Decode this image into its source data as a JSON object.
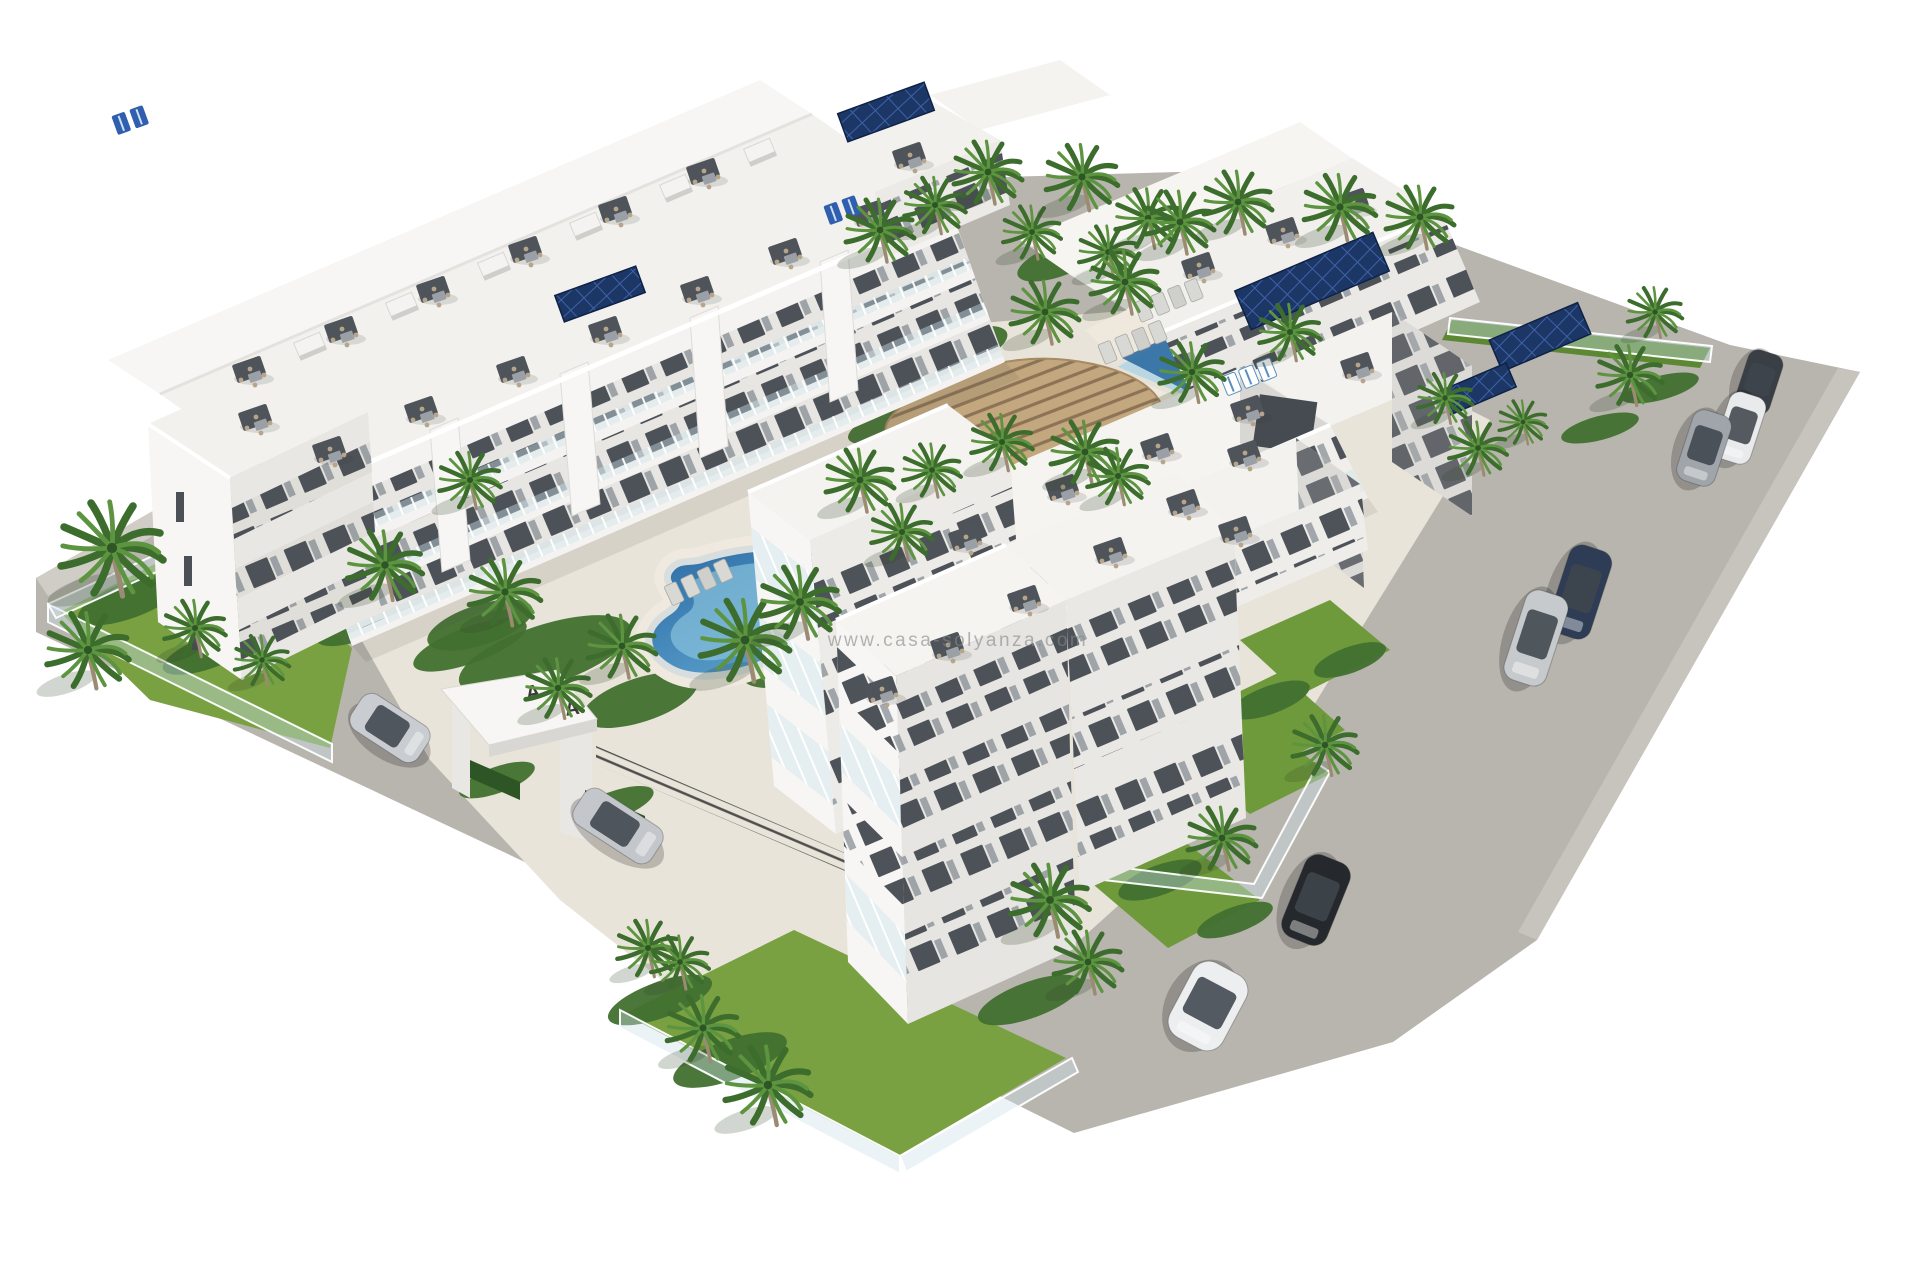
{
  "image": {
    "kind": "3d-architectural-render",
    "description": "Aerial 3D render of a white modern apartment complex with central kidney-shaped pool, rectangular lap pool, wooden pergola, palm gardens, perimeter roads and parked cars",
    "width": 1920,
    "height": 1280
  },
  "watermark": {
    "text": "www.casa-solyanza.com",
    "color": "#868686",
    "opacity": 0.6,
    "x": 958,
    "y": 646,
    "size": 19
  },
  "palette": {
    "bg": "#ffffff",
    "road": "#b8b4ae",
    "sidewalk": "#d0ccc6",
    "courtyard": "#e9e4da",
    "deckpad": "#efe9df",
    "bldg_top": "#f5f4f1",
    "bldg_lit": "#f7f6f4",
    "bldg_mid": "#eceae6",
    "bldg_shade": "#d9d7d3",
    "bldg_deep": "#c2c1bd",
    "window_dark": "#40464d",
    "glass": "#bccfd8",
    "lawn": "#79a141",
    "lawn_dark": "#5d8833",
    "foliage": "#41702f",
    "foliage_dark": "#2e5525",
    "palm1": "#3c6d2d",
    "palm2": "#5d9440",
    "trunk": "#9b8b72",
    "pool_deep": "#2f6da2",
    "pool_mid": "#5d9fc6",
    "pool_light": "#8ec6de",
    "pool_pale": "#b9d6e3",
    "coping": "#d8dedd",
    "pergola_wood": "#c3a87f",
    "pergola_line": "#8d7356",
    "deck_wood": "#d2b58d",
    "solar": "#1c3666",
    "solar_line": "#3f62a8",
    "fence_dark": "#343434",
    "rail_glass": "rgba(206,226,234,0.45)",
    "shadow": "rgba(60,70,55,0.18)"
  },
  "scene": {
    "pools": {
      "kidney_pool": {
        "cx": 770,
        "cy": 614,
        "note": "organic kidney shape, center-left courtyard"
      },
      "lap_pool": {
        "corners": [
          [
            1213,
            312
          ],
          [
            1293,
            353
          ],
          [
            1190,
            400
          ],
          [
            1112,
            367
          ]
        ],
        "note": "rotated rectangular pool, upper right courtyard"
      }
    },
    "entrance": {
      "letters": [
        "A",
        "A"
      ],
      "letter_color": "#3a3a3a"
    },
    "palms": [
      {
        "x": 880,
        "y": 230,
        "s": 1.0,
        "layer": "back"
      },
      {
        "x": 935,
        "y": 205,
        "s": 0.9,
        "layer": "back"
      },
      {
        "x": 988,
        "y": 172,
        "s": 1.0,
        "layer": "back"
      },
      {
        "x": 1032,
        "y": 232,
        "s": 0.85,
        "layer": "back"
      },
      {
        "x": 1082,
        "y": 177,
        "s": 1.05,
        "layer": "back"
      },
      {
        "x": 1108,
        "y": 252,
        "s": 0.85,
        "layer": "back"
      },
      {
        "x": 1148,
        "y": 218,
        "s": 0.95,
        "layer": "back"
      },
      {
        "x": 1180,
        "y": 222,
        "s": 1.0,
        "layer": "back"
      },
      {
        "x": 1238,
        "y": 202,
        "s": 1.0,
        "layer": "back"
      },
      {
        "x": 1340,
        "y": 207,
        "s": 1.05,
        "layer": "back"
      },
      {
        "x": 1420,
        "y": 217,
        "s": 1.0,
        "layer": "back"
      },
      {
        "x": 1445,
        "y": 398,
        "s": 0.8,
        "layer": "back"
      },
      {
        "x": 1523,
        "y": 422,
        "s": 0.7,
        "layer": "back"
      },
      {
        "x": 1655,
        "y": 312,
        "s": 0.8,
        "layer": "back"
      },
      {
        "x": 112,
        "y": 548,
        "s": 1.5,
        "layer": "front"
      },
      {
        "x": 88,
        "y": 650,
        "s": 1.2,
        "layer": "front"
      },
      {
        "x": 195,
        "y": 628,
        "s": 0.9,
        "layer": "front"
      },
      {
        "x": 262,
        "y": 660,
        "s": 0.8,
        "layer": "front"
      },
      {
        "x": 385,
        "y": 565,
        "s": 1.1,
        "layer": "front"
      },
      {
        "x": 470,
        "y": 480,
        "s": 0.9,
        "layer": "front"
      },
      {
        "x": 505,
        "y": 592,
        "s": 1.05,
        "layer": "front"
      },
      {
        "x": 558,
        "y": 688,
        "s": 0.95,
        "layer": "front"
      },
      {
        "x": 622,
        "y": 646,
        "s": 1.0,
        "layer": "front"
      },
      {
        "x": 745,
        "y": 640,
        "s": 1.3,
        "layer": "front"
      },
      {
        "x": 800,
        "y": 602,
        "s": 1.15,
        "layer": "front"
      },
      {
        "x": 860,
        "y": 480,
        "s": 1.0,
        "layer": "front"
      },
      {
        "x": 902,
        "y": 532,
        "s": 0.9,
        "layer": "front"
      },
      {
        "x": 932,
        "y": 470,
        "s": 0.85,
        "layer": "front"
      },
      {
        "x": 1002,
        "y": 442,
        "s": 0.9,
        "layer": "front"
      },
      {
        "x": 1085,
        "y": 452,
        "s": 1.0,
        "layer": "front"
      },
      {
        "x": 1118,
        "y": 476,
        "s": 0.9,
        "layer": "front"
      },
      {
        "x": 1045,
        "y": 312,
        "s": 1.0,
        "layer": "front"
      },
      {
        "x": 1125,
        "y": 282,
        "s": 1.0,
        "layer": "front"
      },
      {
        "x": 1192,
        "y": 372,
        "s": 0.95,
        "layer": "front"
      },
      {
        "x": 1290,
        "y": 332,
        "s": 0.9,
        "layer": "front"
      },
      {
        "x": 1478,
        "y": 448,
        "s": 0.85,
        "layer": "front"
      },
      {
        "x": 1630,
        "y": 375,
        "s": 0.95,
        "layer": "front"
      },
      {
        "x": 648,
        "y": 948,
        "s": 0.9,
        "layer": "front"
      },
      {
        "x": 680,
        "y": 962,
        "s": 0.85,
        "layer": "front"
      },
      {
        "x": 703,
        "y": 1028,
        "s": 1.05,
        "layer": "front"
      },
      {
        "x": 768,
        "y": 1085,
        "s": 1.25,
        "layer": "front"
      },
      {
        "x": 1050,
        "y": 900,
        "s": 1.15,
        "layer": "front"
      },
      {
        "x": 1088,
        "y": 962,
        "s": 1.0,
        "layer": "front"
      },
      {
        "x": 1222,
        "y": 838,
        "s": 1.0,
        "layer": "front"
      },
      {
        "x": 1325,
        "y": 745,
        "s": 0.95,
        "layer": "front"
      }
    ],
    "bushes": [
      {
        "x": 545,
        "y": 655,
        "rx": 90,
        "ry": 30,
        "rot": -18
      },
      {
        "x": 640,
        "y": 700,
        "rx": 60,
        "ry": 22,
        "rot": -18
      },
      {
        "x": 480,
        "y": 625,
        "rx": 55,
        "ry": 20,
        "rot": -18
      },
      {
        "x": 800,
        "y": 660,
        "rx": 60,
        "ry": 22,
        "rot": -18
      },
      {
        "x": 900,
        "y": 300,
        "rx": 70,
        "ry": 22,
        "rot": -20
      },
      {
        "x": 960,
        "y": 350,
        "rx": 50,
        "ry": 18,
        "rot": -20
      },
      {
        "x": 1060,
        "y": 260,
        "rx": 45,
        "ry": 16,
        "rot": -20
      },
      {
        "x": 1210,
        "y": 290,
        "rx": 70,
        "ry": 16,
        "rot": -20
      },
      {
        "x": 1300,
        "y": 312,
        "rx": 60,
        "ry": 16,
        "rot": -20
      },
      {
        "x": 1130,
        "y": 430,
        "rx": 60,
        "ry": 20,
        "rot": -20
      },
      {
        "x": 130,
        "y": 600,
        "rx": 55,
        "ry": 18,
        "rot": -20
      },
      {
        "x": 210,
        "y": 652,
        "rx": 50,
        "ry": 16,
        "rot": -20
      },
      {
        "x": 300,
        "y": 588,
        "rx": 50,
        "ry": 16,
        "rot": -20
      },
      {
        "x": 360,
        "y": 625,
        "rx": 46,
        "ry": 15,
        "rot": -20
      },
      {
        "x": 470,
        "y": 645,
        "rx": 60,
        "ry": 18,
        "rot": -20
      },
      {
        "x": 660,
        "y": 1000,
        "rx": 55,
        "ry": 18,
        "rot": -20
      },
      {
        "x": 730,
        "y": 1060,
        "rx": 60,
        "ry": 20,
        "rot": -20
      },
      {
        "x": 960,
        "y": 940,
        "rx": 48,
        "ry": 16,
        "rot": -20
      },
      {
        "x": 1030,
        "y": 1000,
        "rx": 55,
        "ry": 18,
        "rot": -20
      },
      {
        "x": 1270,
        "y": 700,
        "rx": 42,
        "ry": 14,
        "rot": -20
      },
      {
        "x": 1350,
        "y": 660,
        "rx": 38,
        "ry": 13,
        "rot": -20
      },
      {
        "x": 1600,
        "y": 428,
        "rx": 40,
        "ry": 12,
        "rot": -15
      },
      {
        "x": 1660,
        "y": 388,
        "rx": 40,
        "ry": 12,
        "rot": -15
      },
      {
        "x": 497,
        "y": 780,
        "rx": 40,
        "ry": 13,
        "rot": -20
      },
      {
        "x": 612,
        "y": 806,
        "rx": 44,
        "ry": 14,
        "rot": -20
      },
      {
        "x": 900,
        "y": 420,
        "rx": 55,
        "ry": 16,
        "rot": -20
      },
      {
        "x": 965,
        "y": 390,
        "rx": 50,
        "ry": 15,
        "rot": -20
      },
      {
        "x": 1160,
        "y": 880,
        "rx": 44,
        "ry": 15,
        "rot": -20
      },
      {
        "x": 1235,
        "y": 920,
        "rx": 40,
        "ry": 13,
        "rot": -20
      }
    ],
    "cars": [
      {
        "name": "silver-suv-left-road",
        "x": 390,
        "y": 728,
        "angle": 33,
        "len": 80,
        "wid": 42,
        "color": "#c9cdd1"
      },
      {
        "name": "silver-sedan-left-road",
        "x": 618,
        "y": 826,
        "angle": 33,
        "len": 92,
        "wid": 42,
        "color": "#c3c7cb"
      },
      {
        "name": "dark-hatchback-top-right",
        "x": 1759,
        "y": 382,
        "angle": 108,
        "len": 62,
        "wid": 36,
        "color": "#3a3f45"
      },
      {
        "name": "white-suv-right-road",
        "x": 1740,
        "y": 428,
        "angle": 108,
        "len": 70,
        "wid": 38,
        "color": "#e8eaec"
      },
      {
        "name": "gray-suv-right-road",
        "x": 1704,
        "y": 448,
        "angle": 108,
        "len": 74,
        "wid": 40,
        "color": "#9fa5ab"
      },
      {
        "name": "dark-blue-sedan-right-road",
        "x": 1580,
        "y": 592,
        "angle": 108,
        "len": 92,
        "wid": 44,
        "color": "#2e3d55"
      },
      {
        "name": "silver-sedan-right-road",
        "x": 1536,
        "y": 638,
        "angle": 108,
        "len": 94,
        "wid": 44,
        "color": "#c6cacd"
      },
      {
        "name": "black-suv-lower-right",
        "x": 1316,
        "y": 900,
        "angle": 112,
        "len": 88,
        "wid": 48,
        "color": "#25282c"
      },
      {
        "name": "white-hatchback-bottom",
        "x": 1208,
        "y": 1006,
        "angle": 118,
        "len": 84,
        "wid": 60,
        "color": "#eceef0"
      }
    ],
    "terrace_sets": [
      {
        "x": 332,
        "y": 452
      },
      {
        "x": 424,
        "y": 412
      },
      {
        "x": 516,
        "y": 372
      },
      {
        "x": 608,
        "y": 332
      },
      {
        "x": 700,
        "y": 292
      },
      {
        "x": 788,
        "y": 254
      },
      {
        "x": 872,
        "y": 216
      },
      {
        "x": 252,
        "y": 372
      },
      {
        "x": 344,
        "y": 332
      },
      {
        "x": 436,
        "y": 292
      },
      {
        "x": 528,
        "y": 252
      },
      {
        "x": 618,
        "y": 212
      },
      {
        "x": 706,
        "y": 174
      },
      {
        "x": 258,
        "y": 420
      },
      {
        "x": 912,
        "y": 158
      },
      {
        "x": 1201,
        "y": 268
      },
      {
        "x": 1285,
        "y": 233
      },
      {
        "x": 1355,
        "y": 204
      },
      {
        "x": 1065,
        "y": 490
      },
      {
        "x": 1160,
        "y": 449
      },
      {
        "x": 1250,
        "y": 411
      },
      {
        "x": 1360,
        "y": 368
      },
      {
        "x": 1247,
        "y": 456
      },
      {
        "x": 1186,
        "y": 505
      },
      {
        "x": 1113,
        "y": 553
      },
      {
        "x": 1027,
        "y": 601
      },
      {
        "x": 950,
        "y": 648
      },
      {
        "x": 884,
        "y": 692
      },
      {
        "x": 968,
        "y": 540
      },
      {
        "x": 1238,
        "y": 532
      }
    ],
    "blue_loungers": [
      {
        "x": 130,
        "y": 118
      },
      {
        "x": 842,
        "y": 208
      }
    ],
    "lounger_rows": [
      {
        "x": 1168,
        "y": 300,
        "rot": -22
      },
      {
        "x": 1132,
        "y": 342,
        "rot": -22
      },
      {
        "x": 698,
        "y": 582,
        "rot": -25
      }
    ],
    "striped_loungers": [
      {
        "x": 1248,
        "y": 376,
        "rot": -22
      }
    ],
    "solar_arrays": [
      {
        "x": 886,
        "y": 112,
        "w": 92,
        "h": 30,
        "rot": -20
      },
      {
        "x": 600,
        "y": 294,
        "w": 86,
        "h": 28,
        "rot": -20
      },
      {
        "x": 1312,
        "y": 281,
        "w": 150,
        "h": 42,
        "rot": -23
      },
      {
        "x": 1540,
        "y": 337,
        "w": 96,
        "h": 34,
        "rot": -23
      },
      {
        "x": 1478,
        "y": 389,
        "w": 72,
        "h": 26,
        "rot": -23
      }
    ],
    "bulkheads": [
      {
        "x": 310,
        "y": 346
      },
      {
        "x": 402,
        "y": 306
      },
      {
        "x": 494,
        "y": 266
      },
      {
        "x": 586,
        "y": 226
      },
      {
        "x": 676,
        "y": 188
      },
      {
        "x": 760,
        "y": 152
      }
    ]
  }
}
